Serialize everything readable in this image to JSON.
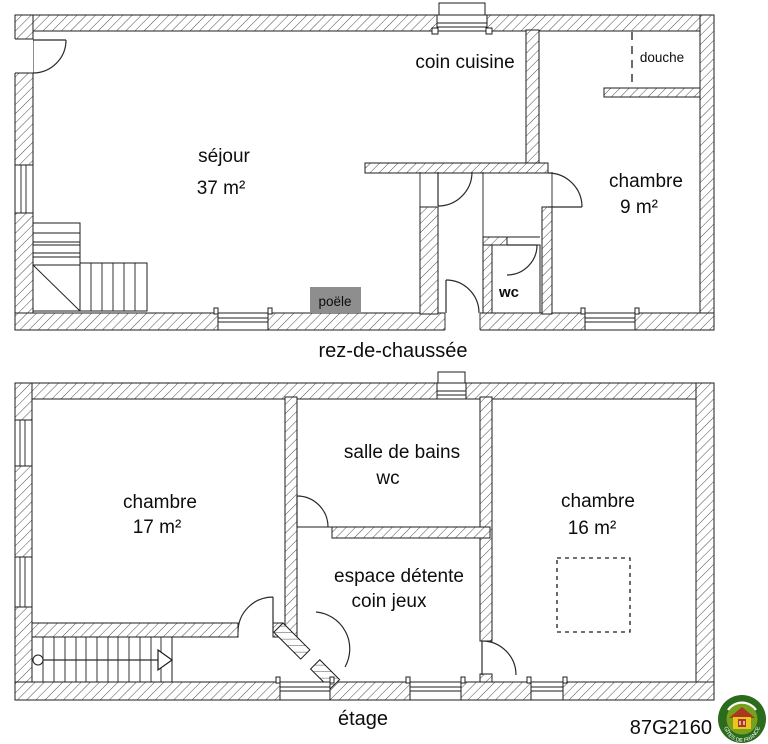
{
  "colors": {
    "line": "#1d1d1d",
    "poele_fill": "#8e8e8e",
    "logo_dark_green": "#2a6b1c",
    "logo_light_green": "#76a11d",
    "logo_yellow": "#eec41c",
    "logo_red": "#a93721"
  },
  "ground_floor": {
    "caption": "rez-de-chaussée",
    "rooms": {
      "sejour": {
        "name": "séjour",
        "area": "37 m²"
      },
      "cuisine": {
        "name": "coin cuisine"
      },
      "chambre": {
        "name": "chambre",
        "area": "9 m²"
      },
      "wc": {
        "name": "wc"
      },
      "douche": {
        "name": "douche"
      }
    },
    "fixtures": {
      "poele": "poële"
    }
  },
  "upper_floor": {
    "caption": "étage",
    "rooms": {
      "chambre_17": {
        "name": "chambre",
        "area": "17 m²"
      },
      "salle_de_bains": {
        "name": "salle de bains",
        "sub": "wc"
      },
      "chambre_16": {
        "name": "chambre",
        "area": "16 m²"
      },
      "espace_detente": {
        "name": "espace détente",
        "sub": "coin jeux"
      }
    }
  },
  "footer": {
    "reference_code": "87G2160",
    "logo_text": "GÎTES DE FRANCE"
  }
}
